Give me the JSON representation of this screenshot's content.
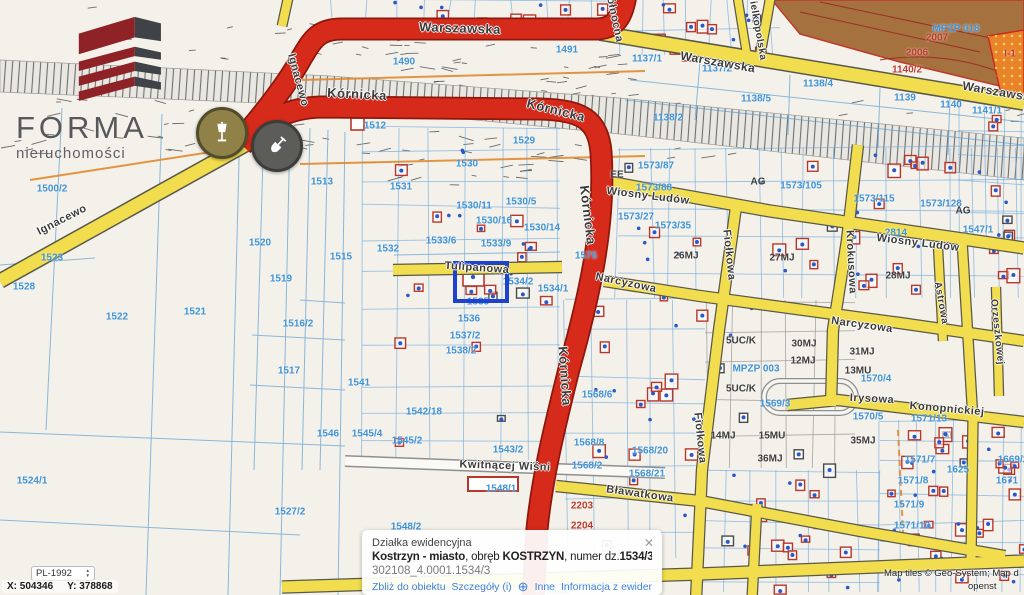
{
  "logo": {
    "name": "FORMA",
    "tagline": "nieruchomości"
  },
  "colors": {
    "accent_red_road": "#d62b1b",
    "yellow_road": "#f2dd4e",
    "parcel_blue": "#3f93d8",
    "building_red": "#b8372a",
    "selection_blue": "#1f41cf",
    "zone_brown": "#a5713e",
    "zone_orange": "#e8832c",
    "link_blue": "#3e82d8"
  },
  "markers": [
    {
      "name": "street-lamp",
      "x": 222,
      "y": 133
    },
    {
      "name": "shovel",
      "x": 277,
      "y": 146
    }
  ],
  "selected_parcel": {
    "x": 453,
    "y": 261,
    "w": 48,
    "h": 34
  },
  "popup": {
    "header": "Działka ewidencyjna",
    "close_glyph": "✕",
    "municipality": "Kostrzyn - miasto",
    "obreb_label": ", obręb ",
    "obreb": "KOSTRZYN",
    "numer_label": ", numer dz.",
    "numer": "1534/3",
    "code": "302108_4.0001.1534/3",
    "plus_glyph": "⊕",
    "links": [
      "Zbliż do obiektu",
      "Szczegóły (i)",
      "Inne",
      "Informacja z ewidencji"
    ]
  },
  "coords": {
    "crs": "PL-1992",
    "x_label": "X: 504346",
    "y_label": "Y: 378868"
  },
  "attribution": {
    "line1": "Map tiles © Geo-System; Map d",
    "line2": "openst"
  },
  "street_labels": [
    {
      "t": "Warszawska",
      "x": 460,
      "y": 28,
      "r": 2,
      "s": 13
    },
    {
      "t": "Warszawska",
      "x": 718,
      "y": 62,
      "r": 10,
      "s": 12
    },
    {
      "t": "Warszawska",
      "x": 1000,
      "y": 92,
      "r": 10,
      "s": 12
    },
    {
      "t": "Kórnicka",
      "x": 357,
      "y": 94,
      "r": 3,
      "s": 13
    },
    {
      "t": "Kórnicka",
      "x": 556,
      "y": 110,
      "r": 14,
      "s": 13
    },
    {
      "t": "Kórnicka",
      "x": 588,
      "y": 215,
      "r": 83,
      "s": 13
    },
    {
      "t": "Kórnicka",
      "x": 565,
      "y": 376,
      "r": 86,
      "s": 13
    },
    {
      "t": "Ignacewo",
      "x": 298,
      "y": 80,
      "r": 75,
      "s": 11
    },
    {
      "t": "Ignacewo",
      "x": 62,
      "y": 220,
      "r": -27,
      "s": 11
    },
    {
      "t": "Północna",
      "x": 614,
      "y": 16,
      "r": 78,
      "s": 11
    },
    {
      "t": "Wielkopolska",
      "x": 757,
      "y": 26,
      "r": 80,
      "s": 10
    },
    {
      "t": "Tulipanowa",
      "x": 477,
      "y": 268,
      "r": 4,
      "s": 11
    },
    {
      "t": "Wiosny Ludów",
      "x": 648,
      "y": 196,
      "r": 7,
      "s": 11
    },
    {
      "t": "Wiosny Ludów",
      "x": 918,
      "y": 243,
      "r": 7,
      "s": 11
    },
    {
      "t": "Narcyzowa",
      "x": 626,
      "y": 283,
      "r": 12,
      "s": 11
    },
    {
      "t": "Narcyzowa",
      "x": 862,
      "y": 325,
      "r": 8,
      "s": 11
    },
    {
      "t": "Fiołkowa",
      "x": 729,
      "y": 255,
      "r": 84,
      "s": 11
    },
    {
      "t": "Fiołkowa",
      "x": 700,
      "y": 438,
      "r": 84,
      "s": 11
    },
    {
      "t": "Krokusowa",
      "x": 851,
      "y": 262,
      "r": 87,
      "s": 11
    },
    {
      "t": "Kwitnącej Wiśni",
      "x": 505,
      "y": 466,
      "r": 2,
      "s": 11
    },
    {
      "t": "Bławatkowa",
      "x": 640,
      "y": 494,
      "r": 8,
      "s": 11
    },
    {
      "t": "Irysowa",
      "x": 872,
      "y": 399,
      "r": 3,
      "s": 11
    },
    {
      "t": "Konopnickiej",
      "x": 947,
      "y": 409,
      "r": 5,
      "s": 11
    },
    {
      "t": "Astrowa",
      "x": 941,
      "y": 303,
      "r": 80,
      "s": 10
    },
    {
      "t": "Orzeszkowej",
      "x": 997,
      "y": 332,
      "r": 84,
      "s": 10
    }
  ],
  "parcel_labels": [
    {
      "t": "1500/2",
      "x": 52,
      "y": 189
    },
    {
      "t": "1523",
      "x": 52,
      "y": 258
    },
    {
      "t": "1528",
      "x": 24,
      "y": 287
    },
    {
      "t": "1522",
      "x": 117,
      "y": 317
    },
    {
      "t": "1521",
      "x": 195,
      "y": 312
    },
    {
      "t": "1520",
      "x": 260,
      "y": 243
    },
    {
      "t": "1519",
      "x": 281,
      "y": 279
    },
    {
      "t": "1516/2",
      "x": 298,
      "y": 324
    },
    {
      "t": "1517",
      "x": 289,
      "y": 371
    },
    {
      "t": "1524/1",
      "x": 32,
      "y": 481
    },
    {
      "t": "1527/2",
      "x": 290,
      "y": 512
    },
    {
      "t": "1513",
      "x": 322,
      "y": 182
    },
    {
      "t": "1515",
      "x": 341,
      "y": 257
    },
    {
      "t": "1531",
      "x": 401,
      "y": 187
    },
    {
      "t": "1532",
      "x": 388,
      "y": 249
    },
    {
      "t": "1512",
      "x": 375,
      "y": 126
    },
    {
      "t": "1490",
      "x": 404,
      "y": 62
    },
    {
      "t": "1491",
      "x": 567,
      "y": 50
    },
    {
      "t": "1529",
      "x": 524,
      "y": 141
    },
    {
      "t": "1530",
      "x": 467,
      "y": 164
    },
    {
      "t": "1530/11",
      "x": 474,
      "y": 206
    },
    {
      "t": "1530/5",
      "x": 521,
      "y": 202
    },
    {
      "t": "1530/16",
      "x": 494,
      "y": 221
    },
    {
      "t": "1530/14",
      "x": 542,
      "y": 228
    },
    {
      "t": "1533/6",
      "x": 441,
      "y": 241
    },
    {
      "t": "1533/9",
      "x": 496,
      "y": 244
    },
    {
      "t": "1534/2",
      "x": 518,
      "y": 282
    },
    {
      "t": "1534/1",
      "x": 553,
      "y": 289
    },
    {
      "t": "1535",
      "x": 478,
      "y": 302
    },
    {
      "t": "1536",
      "x": 469,
      "y": 319
    },
    {
      "t": "1537/2",
      "x": 465,
      "y": 336
    },
    {
      "t": "1538/2",
      "x": 461,
      "y": 351
    },
    {
      "t": "1541",
      "x": 359,
      "y": 383
    },
    {
      "t": "1542/18",
      "x": 424,
      "y": 412
    },
    {
      "t": "1546",
      "x": 328,
      "y": 434
    },
    {
      "t": "1545/4",
      "x": 367,
      "y": 434
    },
    {
      "t": "1545/2",
      "x": 407,
      "y": 441
    },
    {
      "t": "1543/2",
      "x": 508,
      "y": 450
    },
    {
      "t": "1548/1",
      "x": 501,
      "y": 489
    },
    {
      "t": "1548/2",
      "x": 406,
      "y": 527
    },
    {
      "t": "1550/23",
      "x": 553,
      "y": 591
    },
    {
      "t": "1575",
      "x": 586,
      "y": 256
    },
    {
      "t": "1573/87",
      "x": 656,
      "y": 166
    },
    {
      "t": "1573/88",
      "x": 654,
      "y": 188
    },
    {
      "t": "1573/27",
      "x": 636,
      "y": 217
    },
    {
      "t": "1573/35",
      "x": 673,
      "y": 226
    },
    {
      "t": "1573/105",
      "x": 801,
      "y": 186
    },
    {
      "t": "1573/115",
      "x": 874,
      "y": 199
    },
    {
      "t": "1573/128",
      "x": 941,
      "y": 204
    },
    {
      "t": "1547/1",
      "x": 978,
      "y": 230
    },
    {
      "t": "2814",
      "x": 896,
      "y": 233
    },
    {
      "t": "1137/1",
      "x": 647,
      "y": 59
    },
    {
      "t": "1137/2",
      "x": 717,
      "y": 69
    },
    {
      "t": "1138/4",
      "x": 818,
      "y": 84
    },
    {
      "t": "1138/5",
      "x": 756,
      "y": 99
    },
    {
      "t": "1139",
      "x": 905,
      "y": 98
    },
    {
      "t": "1140",
      "x": 951,
      "y": 105
    },
    {
      "t": "1141/1",
      "x": 987,
      "y": 111
    },
    {
      "t": "1138/2",
      "x": 668,
      "y": 118
    },
    {
      "t": "MPZP 018",
      "x": 956,
      "y": 29
    },
    {
      "t": "MPZP 003",
      "x": 756,
      "y": 369
    },
    {
      "t": "1569/3",
      "x": 775,
      "y": 404
    },
    {
      "t": "1570/4",
      "x": 876,
      "y": 379
    },
    {
      "t": "1570/5",
      "x": 868,
      "y": 417
    },
    {
      "t": "1571/13",
      "x": 929,
      "y": 419
    },
    {
      "t": "1571/7",
      "x": 920,
      "y": 460
    },
    {
      "t": "1571/8",
      "x": 913,
      "y": 481
    },
    {
      "t": "1571/9",
      "x": 909,
      "y": 505
    },
    {
      "t": "1571/10",
      "x": 912,
      "y": 526
    },
    {
      "t": "1568/6",
      "x": 597,
      "y": 395
    },
    {
      "t": "1568/8",
      "x": 589,
      "y": 443
    },
    {
      "t": "1568/2",
      "x": 587,
      "y": 466
    },
    {
      "t": "1568/20",
      "x": 650,
      "y": 451
    },
    {
      "t": "1568/21",
      "x": 647,
      "y": 474
    },
    {
      "t": "1625",
      "x": 958,
      "y": 470
    },
    {
      "t": "1669/2",
      "x": 1013,
      "y": 460
    },
    {
      "t": "1671",
      "x": 1007,
      "y": 481
    },
    {
      "t": "26MJ",
      "x": 686,
      "y": 256,
      "c": "d"
    },
    {
      "t": "27MJ",
      "x": 782,
      "y": 258,
      "c": "d"
    },
    {
      "t": "28MJ",
      "x": 898,
      "y": 276,
      "c": "d"
    },
    {
      "t": "30MJ",
      "x": 804,
      "y": 344,
      "c": "d"
    },
    {
      "t": "12MJ",
      "x": 803,
      "y": 361,
      "c": "d"
    },
    {
      "t": "31MJ",
      "x": 862,
      "y": 352,
      "c": "d"
    },
    {
      "t": "13MU",
      "x": 858,
      "y": 371,
      "c": "d"
    },
    {
      "t": "15MU",
      "x": 772,
      "y": 436,
      "c": "d"
    },
    {
      "t": "35MJ",
      "x": 863,
      "y": 441,
      "c": "d"
    },
    {
      "t": "36MJ",
      "x": 770,
      "y": 459,
      "c": "d"
    },
    {
      "t": "14MJ",
      "x": 723,
      "y": 436,
      "c": "d"
    },
    {
      "t": "5UC/K",
      "x": 741,
      "y": 341,
      "c": "d"
    },
    {
      "t": "5UC/K",
      "x": 741,
      "y": 389,
      "c": "d"
    },
    {
      "t": "AG",
      "x": 758,
      "y": 182,
      "c": "d"
    },
    {
      "t": "AG",
      "x": 963,
      "y": 211,
      "c": "d"
    },
    {
      "t": "EE",
      "x": 617,
      "y": 175,
      "c": "d"
    },
    {
      "t": "2007",
      "x": 937,
      "y": 38,
      "c": "r"
    },
    {
      "t": "2006",
      "x": 917,
      "y": 53,
      "c": "r"
    },
    {
      "t": "1140/2",
      "x": 907,
      "y": 70,
      "c": "r"
    },
    {
      "t": "I-1",
      "x": 1010,
      "y": 54,
      "c": "r"
    },
    {
      "t": "2203",
      "x": 582,
      "y": 506,
      "c": "r"
    },
    {
      "t": "2204",
      "x": 582,
      "y": 526,
      "c": "r"
    }
  ]
}
